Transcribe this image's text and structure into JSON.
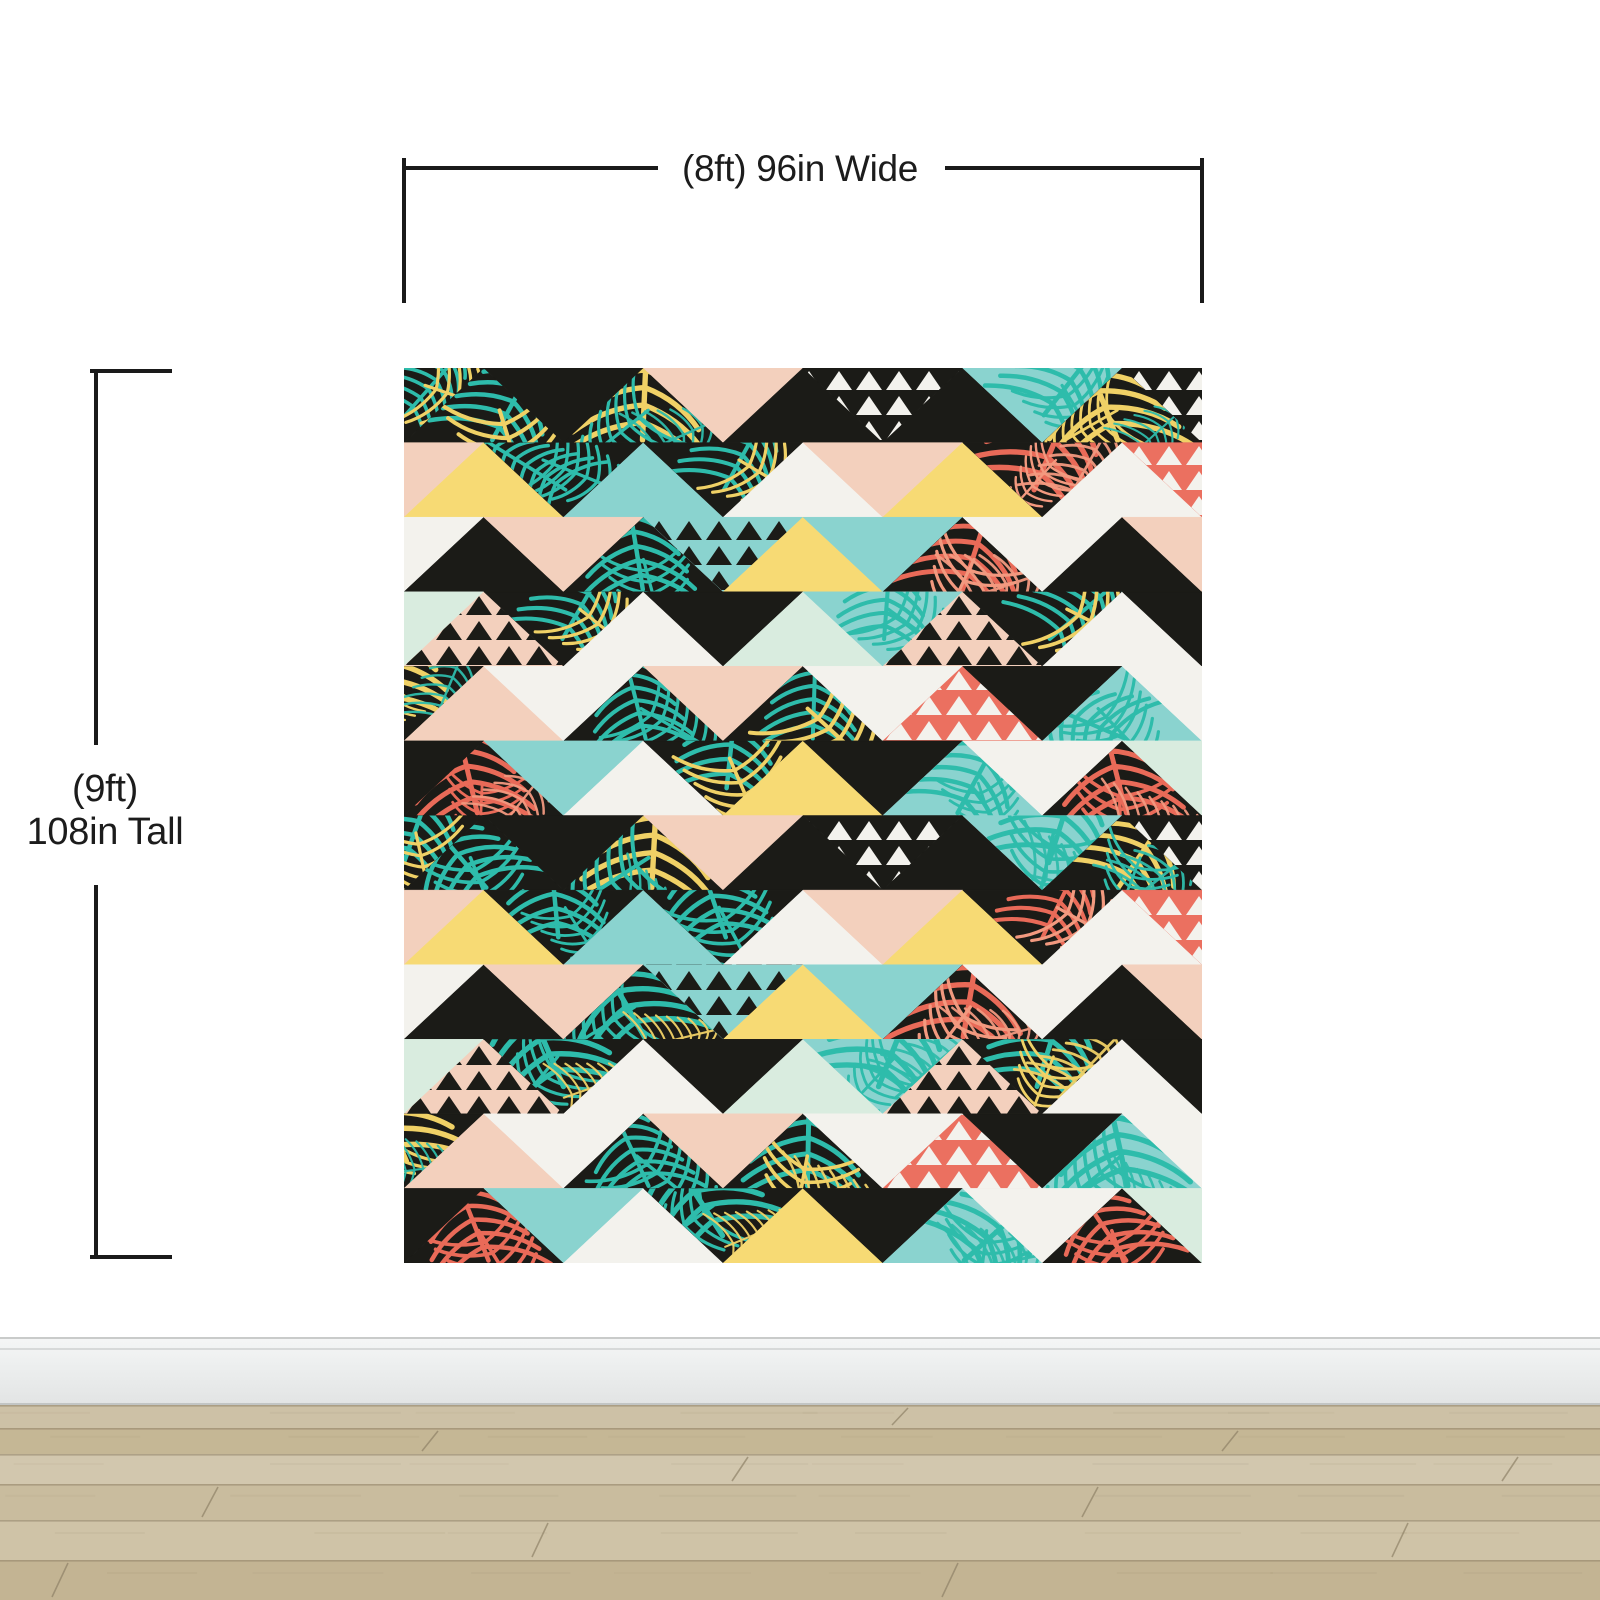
{
  "scene": {
    "description": "Wall mural product mockup on white wall with wood floor",
    "background_color": "#ffffff"
  },
  "dimension_labels": {
    "width": "(8ft) 96in Wide",
    "height_line1": "(9ft)",
    "height_line2": "108in Tall"
  },
  "mural": {
    "depicted_width": "96in",
    "depicted_height": "108in",
    "grid": {
      "rows": 12,
      "cells_per_row": 11,
      "triangle_base_px": 159.6,
      "row_height_px": 74.58
    },
    "palette": {
      "K": "#1b1b17",
      "W": "#f3f2ed",
      "T": "#8ad3cf",
      "M": "#d9ecdf",
      "P": "#f3d0bd",
      "Y": "#f7da74",
      "C": "#eb7060"
    },
    "leaf_colors": {
      "t": "#2ebcab",
      "y": "#f0d166",
      "c": "#e96a58"
    },
    "leaf_secondary": {
      "t": "#f0d166",
      "y": "#2ebcab",
      "c": "#f2997f"
    },
    "mini_colors": {
      "m": "#1b1b17",
      "w": "#f3f2ed"
    },
    "rows": [
      [
        "K:t",
        "K:t",
        "K",
        "K:y",
        "P",
        "K",
        "K:w",
        "K",
        "T:t",
        "K:y",
        "K:w"
      ],
      [
        "P",
        "Y",
        "K:t",
        "T",
        "K:t",
        "W",
        "P",
        "Y",
        "K:c",
        "W",
        "C:w"
      ],
      [
        "W",
        "K",
        "P",
        "K:t",
        "T:m",
        "Y",
        "T",
        "K:c",
        "W",
        "K",
        "P"
      ],
      [
        "M",
        "P:m",
        "K:t",
        "W",
        "K",
        "M",
        "T:t",
        "P:m",
        "K:t",
        "W",
        "K"
      ],
      [
        "K:y",
        "P",
        "W",
        "K:t",
        "P",
        "K:t",
        "W",
        "C:w",
        "K",
        "T:t",
        "W"
      ],
      [
        "K",
        "K:c",
        "T",
        "W",
        "K:t",
        "Y",
        "K",
        "T:t",
        "W",
        "K:c",
        "M"
      ],
      [
        "K:t",
        "K:t",
        "K",
        "K:y",
        "P",
        "K",
        "K:w",
        "K",
        "T:t",
        "K:y",
        "K:w"
      ],
      [
        "P",
        "Y",
        "K:t",
        "T",
        "K:t",
        "W",
        "P",
        "Y",
        "K:c",
        "W",
        "C:w"
      ],
      [
        "W",
        "K",
        "P",
        "K:t",
        "T:m",
        "Y",
        "T",
        "K:c",
        "W",
        "K",
        "P"
      ],
      [
        "M",
        "P:m",
        "K:t",
        "W",
        "K",
        "M",
        "T:t",
        "P:m",
        "K:t",
        "W",
        "K"
      ],
      [
        "K:y",
        "P",
        "W",
        "K:t",
        "P",
        "K:t",
        "W",
        "C:w",
        "K",
        "T:t",
        "W"
      ],
      [
        "K",
        "K:c",
        "T",
        "W",
        "K:t",
        "Y",
        "K",
        "T:t",
        "W",
        "K:c",
        "M"
      ]
    ]
  },
  "baseboard": {
    "top_line": "#c9cbca",
    "groove": "#d7d9d9",
    "face": "#edefef",
    "shadow": "#c2c5c4"
  },
  "floor": {
    "seam_color": "#8f8267",
    "bands": [
      {
        "h": 23,
        "color": "#cdc1a6"
      },
      {
        "h": 26,
        "color": "#c5b795"
      },
      {
        "h": 30,
        "color": "#d2c7ae"
      },
      {
        "h": 36,
        "color": "#c9bc9e"
      },
      {
        "h": 40,
        "color": "#cfc3a7"
      },
      {
        "h": 40,
        "color": "#c3b493"
      }
    ],
    "joints": [
      [
        900,
        0
      ],
      [
        430,
        1
      ],
      [
        1230,
        1
      ],
      [
        740,
        2
      ],
      [
        1510,
        2
      ],
      [
        210,
        3
      ],
      [
        1090,
        3
      ],
      [
        540,
        4
      ],
      [
        1400,
        4
      ],
      [
        60,
        5
      ],
      [
        950,
        5
      ]
    ]
  }
}
